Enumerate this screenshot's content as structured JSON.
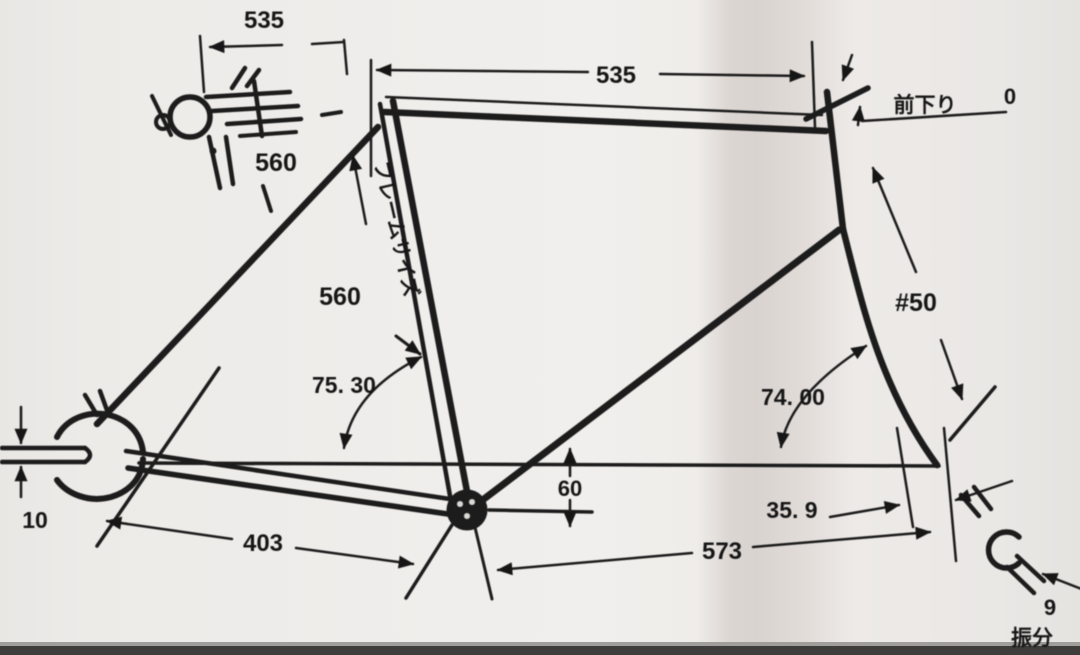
{
  "diagram": {
    "title": "bicycle frame geometry drawing",
    "measurements": {
      "stem_span": "535",
      "top_tube": "535",
      "front_drop_label": "前下り",
      "front_drop_value": "0",
      "stem_size": "560",
      "frame_size_value": "560",
      "frame_size_label": "フレームサイズ",
      "seat_tube_angle": "75. 30",
      "head_tube_angle": "74. 00",
      "fork_dim": "#50",
      "bb_drop": "60",
      "fork_offset": "35. 9",
      "rear_axle": "10",
      "chainstay": "403",
      "front_center": "573",
      "front_end_value": "9",
      "front_end_label": "振分"
    }
  }
}
